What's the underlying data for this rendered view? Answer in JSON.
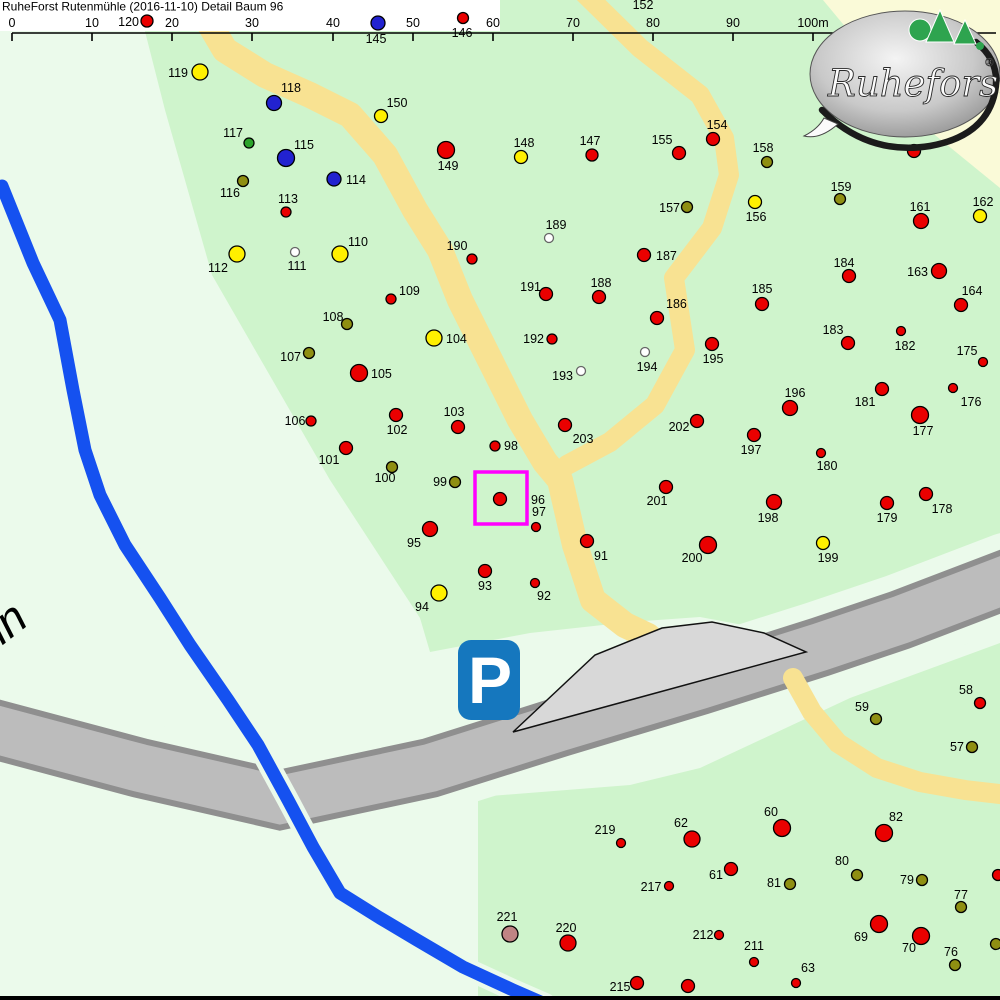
{
  "title": {
    "text": "RuheForst Rutenmühle (2016-11-10) Detail  Baum 96"
  },
  "logo": {
    "text": "Ruheforst",
    "reg": "®"
  },
  "parking": {
    "label": "P"
  },
  "street_label": {
    "text": "hn"
  },
  "selection": {
    "tree": "96",
    "x": 475,
    "y": 472,
    "w": 52,
    "h": 52
  },
  "colors": {
    "red": "#EA0000",
    "yellow": "#FFF000",
    "blue": "#2222D0",
    "green": "#2BA32B",
    "olive": "#8F8F12",
    "white": "#FFFFFF",
    "rose": "#C08484",
    "selection": "#FF00FF",
    "forest": "#CFF4CC",
    "pale": "#EBFAEB",
    "pale_yellow": "#FAFAD8",
    "path": "#F8E292",
    "road_fill": "#BCBCBC",
    "road_border": "#8F8F8F",
    "parking_fill": "#D8D8D8",
    "stream": "#1551F0",
    "parking_blue": "#1577BE"
  },
  "scalebar": {
    "line_y": 33,
    "line_x1": 12,
    "line_x2": 996,
    "tick_bottom": 41,
    "label_y": 27,
    "ticks": [
      {
        "x": 12,
        "label": "0"
      },
      {
        "x": 92,
        "label": "10"
      },
      {
        "x": 172,
        "label": "20"
      },
      {
        "x": 252,
        "label": "30"
      },
      {
        "x": 333,
        "label": "40"
      },
      {
        "x": 413,
        "label": "50"
      },
      {
        "x": 493,
        "label": "60"
      },
      {
        "x": 573,
        "label": "70"
      },
      {
        "x": 653,
        "label": "80"
      },
      {
        "x": 733,
        "label": "90"
      },
      {
        "x": 813,
        "label": "100m"
      }
    ]
  },
  "extra_labels": [
    {
      "text": "152",
      "x": 643,
      "y": 9
    }
  ],
  "trees_fields": [
    "id",
    "x",
    "y",
    "radius",
    "color",
    "label_x",
    "label_y",
    "anchor"
  ],
  "trees": [
    [
      "120",
      147,
      21,
      6,
      "red",
      139,
      26,
      "e"
    ],
    [
      "145",
      378,
      23,
      7,
      "blue",
      376,
      43,
      "m"
    ],
    [
      "146",
      463,
      18,
      5.5,
      "red",
      462,
      37,
      "m"
    ],
    [
      "119",
      200,
      72,
      8,
      "yellow",
      188,
      77,
      "e"
    ],
    [
      "118",
      274,
      103,
      7.5,
      "blue",
      291,
      92,
      "m"
    ],
    [
      "150",
      381,
      116,
      6.5,
      "yellow",
      397,
      107,
      "m"
    ],
    [
      "117",
      249,
      143,
      5,
      "green",
      243,
      137,
      "e"
    ],
    [
      "115",
      286,
      158,
      8.5,
      "blue",
      304,
      149,
      "m"
    ],
    [
      "149",
      446,
      150,
      8.5,
      "red",
      448,
      170,
      "m"
    ],
    [
      "148",
      521,
      157,
      6.5,
      "yellow",
      524,
      147,
      "m"
    ],
    [
      "147",
      592,
      155,
      6,
      "red",
      590,
      145,
      "m"
    ],
    [
      "155",
      679,
      153,
      6.5,
      "red",
      662,
      144,
      "m"
    ],
    [
      "154",
      713,
      139,
      6.5,
      "red",
      717,
      129,
      "m"
    ],
    [
      "158",
      767,
      162,
      5.5,
      "olive",
      763,
      152,
      "m"
    ],
    [
      "",
      914,
      151,
      6.5,
      "red",
      0,
      0,
      "m"
    ],
    [
      "114",
      334,
      179,
      7,
      "blue",
      346,
      184,
      "s"
    ],
    [
      "116",
      243,
      181,
      5.5,
      "olive",
      230,
      197,
      "m"
    ],
    [
      "156",
      755,
      202,
      6.5,
      "yellow",
      756,
      221,
      "m"
    ],
    [
      "157",
      687,
      207,
      5.5,
      "olive",
      680,
      212,
      "e"
    ],
    [
      "159",
      840,
      199,
      5.5,
      "olive",
      841,
      191,
      "m"
    ],
    [
      "161",
      921,
      221,
      7.5,
      "red",
      920,
      211,
      "m"
    ],
    [
      "162",
      980,
      216,
      6.5,
      "yellow",
      983,
      206,
      "m"
    ],
    [
      "113",
      286,
      212,
      5,
      "red",
      288,
      203,
      "m"
    ],
    [
      "110",
      340,
      254,
      8,
      "yellow",
      358,
      246,
      "m"
    ],
    [
      "111",
      295,
      252,
      4.5,
      "white",
      297,
      270,
      "m"
    ],
    [
      "112",
      237,
      254,
      8,
      "yellow",
      218,
      272,
      "m"
    ],
    [
      "189",
      549,
      238,
      4.5,
      "white",
      556,
      229,
      "m"
    ],
    [
      "190",
      472,
      259,
      5,
      "red",
      457,
      250,
      "m"
    ],
    [
      "187",
      644,
      255,
      6.5,
      "red",
      656,
      260,
      "s"
    ],
    [
      "184",
      849,
      276,
      6.5,
      "red",
      844,
      267,
      "m"
    ],
    [
      "163",
      939,
      271,
      7.5,
      "red",
      928,
      276,
      "e"
    ],
    [
      "164",
      961,
      305,
      6.5,
      "red",
      972,
      295,
      "m"
    ],
    [
      "185",
      762,
      304,
      6.5,
      "red",
      762,
      293,
      "m"
    ],
    [
      "109",
      391,
      299,
      5,
      "red",
      399,
      295,
      "s"
    ],
    [
      "191",
      546,
      294,
      6.5,
      "red",
      541,
      291,
      "e"
    ],
    [
      "188",
      599,
      297,
      6.5,
      "red",
      601,
      287,
      "m"
    ],
    [
      "186",
      657,
      318,
      6.5,
      "red",
      666,
      308,
      "s"
    ],
    [
      "183",
      848,
      343,
      6.5,
      "red",
      833,
      334,
      "m"
    ],
    [
      "182",
      901,
      331,
      4.5,
      "red",
      905,
      350,
      "m"
    ],
    [
      "108",
      347,
      324,
      5.5,
      "olive",
      333,
      321,
      "m"
    ],
    [
      "104",
      434,
      338,
      8,
      "yellow",
      446,
      343,
      "s"
    ],
    [
      "192",
      552,
      339,
      5,
      "red",
      544,
      343,
      "e"
    ],
    [
      "175",
      983,
      362,
      4.5,
      "red",
      967,
      355,
      "m"
    ],
    [
      "107",
      309,
      353,
      5.5,
      "olive",
      301,
      361,
      "e"
    ],
    [
      "195",
      712,
      344,
      6.5,
      "red",
      713,
      363,
      "m"
    ],
    [
      "194",
      645,
      352,
      4.5,
      "white",
      647,
      371,
      "m"
    ],
    [
      "193",
      581,
      371,
      4.5,
      "white",
      573,
      380,
      "e"
    ],
    [
      "105",
      359,
      373,
      8.5,
      "red",
      371,
      378,
      "s"
    ],
    [
      "196",
      790,
      408,
      7.5,
      "red",
      795,
      397,
      "m"
    ],
    [
      "181",
      882,
      389,
      6.5,
      "red",
      865,
      406,
      "m"
    ],
    [
      "176",
      953,
      388,
      4.5,
      "red",
      971,
      406,
      "m"
    ],
    [
      "177",
      920,
      415,
      8.5,
      "red",
      923,
      435,
      "m"
    ],
    [
      "202",
      697,
      421,
      6.5,
      "red",
      679,
      431,
      "m"
    ],
    [
      "197",
      754,
      435,
      6.5,
      "red",
      751,
      454,
      "m"
    ],
    [
      "180",
      821,
      453,
      4.5,
      "red",
      827,
      470,
      "m"
    ],
    [
      "102",
      396,
      415,
      6.5,
      "red",
      397,
      434,
      "m"
    ],
    [
      "103",
      458,
      427,
      6.5,
      "red",
      454,
      416,
      "m"
    ],
    [
      "106",
      311,
      421,
      5,
      "red",
      295,
      425,
      "m"
    ],
    [
      "98",
      495,
      446,
      5,
      "red",
      504,
      450,
      "s"
    ],
    [
      "101",
      346,
      448,
      6.5,
      "red",
      329,
      464,
      "m"
    ],
    [
      "100",
      392,
      467,
      5.5,
      "olive",
      385,
      482,
      "m"
    ],
    [
      "99",
      455,
      482,
      5.5,
      "olive",
      447,
      486,
      "e"
    ],
    [
      "96",
      500,
      499,
      6.5,
      "red",
      531,
      504,
      "s"
    ],
    [
      "97",
      536,
      527,
      4.5,
      "red",
      532,
      516,
      "s"
    ],
    [
      "203",
      565,
      425,
      6.5,
      "red",
      583,
      443,
      "m"
    ],
    [
      "201",
      666,
      487,
      6.5,
      "red",
      657,
      505,
      "m"
    ],
    [
      "95",
      430,
      529,
      7.5,
      "red",
      414,
      547,
      "m"
    ],
    [
      "91",
      587,
      541,
      6.5,
      "red",
      601,
      560,
      "m"
    ],
    [
      "198",
      774,
      502,
      7.5,
      "red",
      768,
      522,
      "m"
    ],
    [
      "199",
      823,
      543,
      6.5,
      "yellow",
      828,
      562,
      "m"
    ],
    [
      "200",
      708,
      545,
      8.5,
      "red",
      692,
      562,
      "m"
    ],
    [
      "179",
      887,
      503,
      6.5,
      "red",
      887,
      522,
      "m"
    ],
    [
      "178",
      926,
      494,
      6.5,
      "red",
      942,
      513,
      "m"
    ],
    [
      "93",
      485,
      571,
      6.5,
      "red",
      485,
      590,
      "m"
    ],
    [
      "92",
      535,
      583,
      4.5,
      "red",
      544,
      600,
      "m"
    ],
    [
      "94",
      439,
      593,
      8,
      "yellow",
      422,
      611,
      "m"
    ],
    [
      "59",
      876,
      719,
      5.5,
      "olive",
      862,
      711,
      "m"
    ],
    [
      "58",
      980,
      703,
      5.5,
      "red",
      966,
      694,
      "m"
    ],
    [
      "57",
      972,
      747,
      5.5,
      "olive",
      957,
      751,
      "m"
    ],
    [
      "219",
      621,
      843,
      4.5,
      "red",
      605,
      834,
      "m"
    ],
    [
      "62",
      692,
      839,
      8,
      "red",
      681,
      827,
      "m"
    ],
    [
      "60",
      782,
      828,
      8.5,
      "red",
      771,
      816,
      "m"
    ],
    [
      "82",
      884,
      833,
      8.5,
      "red",
      896,
      821,
      "m"
    ],
    [
      "61",
      731,
      869,
      6.5,
      "red",
      716,
      879,
      "m"
    ],
    [
      "80",
      857,
      875,
      5.5,
      "olive",
      842,
      865,
      "m"
    ],
    [
      "81",
      790,
      884,
      5.5,
      "olive",
      774,
      887,
      "m"
    ],
    [
      "79",
      922,
      880,
      5.5,
      "olive",
      907,
      884,
      "m"
    ],
    [
      "217",
      669,
      886,
      4.5,
      "red",
      651,
      891,
      "m"
    ],
    [
      "77",
      961,
      907,
      5.5,
      "olive",
      961,
      899,
      "m"
    ],
    [
      "",
      998,
      875,
      5.5,
      "red",
      0,
      0,
      "m"
    ],
    [
      "221",
      510,
      934,
      8,
      "rose",
      507,
      921,
      "m"
    ],
    [
      "220",
      568,
      943,
      8,
      "red",
      566,
      932,
      "m"
    ],
    [
      "212",
      719,
      935,
      4.5,
      "red",
      703,
      939,
      "m"
    ],
    [
      "69",
      879,
      924,
      8.5,
      "red",
      861,
      941,
      "m"
    ],
    [
      "70",
      921,
      936,
      8.5,
      "red",
      909,
      952,
      "m"
    ],
    [
      "211",
      754,
      962,
      4.5,
      "red",
      754,
      950,
      "m"
    ],
    [
      "76",
      955,
      965,
      5.5,
      "olive",
      951,
      956,
      "m"
    ],
    [
      "",
      996,
      944,
      5.5,
      "olive",
      0,
      0,
      "m"
    ],
    [
      "63",
      796,
      983,
      4.5,
      "red",
      808,
      972,
      "m"
    ],
    [
      "215",
      637,
      983,
      6.5,
      "red",
      620,
      991,
      "m"
    ],
    [
      "214",
      688,
      986,
      6.5,
      "red",
      688,
      1008,
      "m"
    ]
  ]
}
